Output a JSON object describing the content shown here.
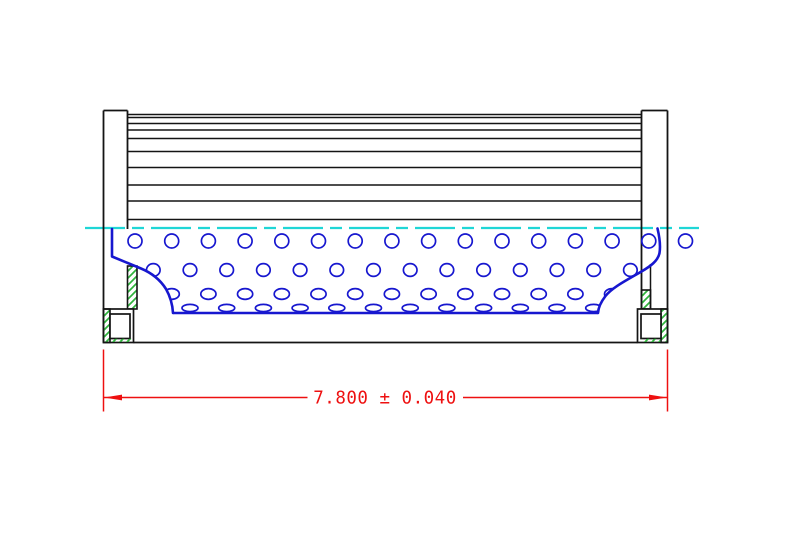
{
  "page": {
    "description": "CAD cross-section drawing of a cylindrical filter element: pleated media (top half), perforated center tube (lower half), hatched end caps with seal grooves, and an overall length dimension"
  },
  "dimension": {
    "label": "7.800 ± 0.040",
    "value": "7.800",
    "plus_minus": "±",
    "tolerance": "0.040"
  },
  "colors": {
    "outline": "#141414",
    "media": "#1717cf",
    "centerline": "#1fd6d6",
    "hatch": "#2fb43c",
    "dimension": "#ee1010",
    "background": "#ffffff"
  },
  "drawing": {
    "pleat_lines": {
      "x1": 128,
      "x2": 641.5,
      "y_values": [
        114.5,
        117.5,
        123.5,
        130,
        138.5,
        151.5,
        167.5,
        185,
        201,
        219.5
      ]
    },
    "perforation_rows": [
      {
        "y": 241,
        "rx": 7.0,
        "ry": 7.0,
        "start_x": 135.0,
        "step_x": 36.7,
        "count": 15
      },
      {
        "y": 270,
        "rx": 6.8,
        "ry": 6.4,
        "start_x": 153.3,
        "step_x": 36.7,
        "count": 14
      },
      {
        "y": 294,
        "rx": 7.6,
        "ry": 5.4,
        "start_x": 135.0,
        "step_x": 36.7,
        "count": 15
      },
      {
        "y": 308,
        "rx": 8.0,
        "ry": 3.6,
        "start_x": 153.3,
        "step_x": 36.7,
        "count": 14
      }
    ],
    "extra_holes": [
      {
        "x": 685.5,
        "y": 241,
        "rx": 7,
        "ry": 7
      }
    ]
  }
}
